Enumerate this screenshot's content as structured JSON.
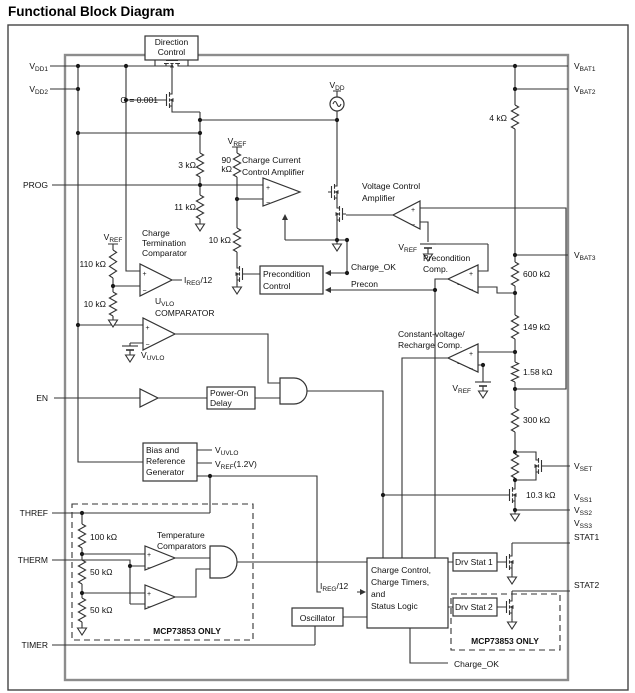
{
  "title": "Functional Block Diagram",
  "pins": {
    "left": [
      {
        "main": "V",
        "sub": "DD1"
      },
      {
        "main": "V",
        "sub": "DD2"
      },
      {
        "main": "PROG",
        "sub": ""
      },
      {
        "main": "EN",
        "sub": ""
      },
      {
        "main": "THREF",
        "sub": ""
      },
      {
        "main": "THERM",
        "sub": ""
      },
      {
        "main": "TIMER",
        "sub": ""
      }
    ],
    "right": [
      {
        "main": "V",
        "sub": "BAT1"
      },
      {
        "main": "V",
        "sub": "BAT2"
      },
      {
        "main": "V",
        "sub": "BAT3"
      },
      {
        "main": "V",
        "sub": "SET"
      },
      {
        "main": "V",
        "sub": "SS1"
      },
      {
        "main": "V",
        "sub": "SS2"
      },
      {
        "main": "V",
        "sub": "SS3"
      },
      {
        "main": "STAT1",
        "sub": ""
      },
      {
        "main": "STAT2",
        "sub": ""
      }
    ]
  },
  "blocks": {
    "direction_control": {
      "line1": "Direction",
      "line2": "Control"
    },
    "precondition_control": {
      "line1": "Precondition",
      "line2": "Control"
    },
    "power_on_delay": {
      "line1": "Power-On",
      "line2": "Delay"
    },
    "bias_generator": {
      "line1": "Bias and",
      "line2": "Reference",
      "line3": "Generator"
    },
    "oscillator": "Oscillator",
    "charge_logic": {
      "line1": "Charge Control,",
      "line2": "Charge Timers,",
      "line3": "and",
      "line4": "Status Logic"
    },
    "drv_stat1": "Drv Stat 1",
    "drv_stat2": "Drv Stat 2"
  },
  "amplifiers": {
    "charge_current": {
      "line1": "Charge Current",
      "line2": "Control Amplifier"
    },
    "voltage_control": {
      "line1": "Voltage Control",
      "line2": "Amplifier"
    },
    "charge_termination": {
      "line1": "Charge",
      "line2": "Termination",
      "line3": "Comparator"
    },
    "uvlo": {
      "main": "U",
      "sub": "VLO",
      "line2": "COMPARATOR"
    },
    "precondition": {
      "line1": "Precondition",
      "line2": "Comp."
    },
    "cv_recharge": {
      "line1": "Constant-voltage/",
      "line2": "Recharge Comp."
    },
    "temperature": {
      "line1": "Temperature",
      "line2": "Comparators"
    }
  },
  "resistors": {
    "r3k": "3 kΩ",
    "r11k": "11 kΩ",
    "r90k_line1": "90",
    "r90k_line2": "kΩ",
    "r10k_prog": "10 kΩ",
    "r110k": "110 kΩ",
    "r10k_term": "10 kΩ",
    "r4k": "4 kΩ",
    "r600k": "600 kΩ",
    "r149k": "149 kΩ",
    "r1_58k": "1.58 kΩ",
    "r300k": "300 kΩ",
    "r10_3k": "10.3 kΩ",
    "r100k": "100 kΩ",
    "r50k_a": "50 kΩ",
    "r50k_b": "50 kΩ"
  },
  "signals": {
    "gain": "G = 0.001",
    "vdd": {
      "main": "V",
      "sub": "DD"
    },
    "vref": {
      "main": "V",
      "sub": "REF"
    },
    "vref_12": {
      "main": "V",
      "sub": "REF",
      "post": "(1.2V)"
    },
    "vuvlo": {
      "main": "V",
      "sub": "UVLO"
    },
    "ireg12": {
      "main": "I",
      "sub": "REG",
      "post": "/12"
    },
    "charge_ok": "Charge_OK",
    "precon": "Precon",
    "mcp_only": "MCP73853 ONLY",
    "plus": "+",
    "minus": "−"
  }
}
